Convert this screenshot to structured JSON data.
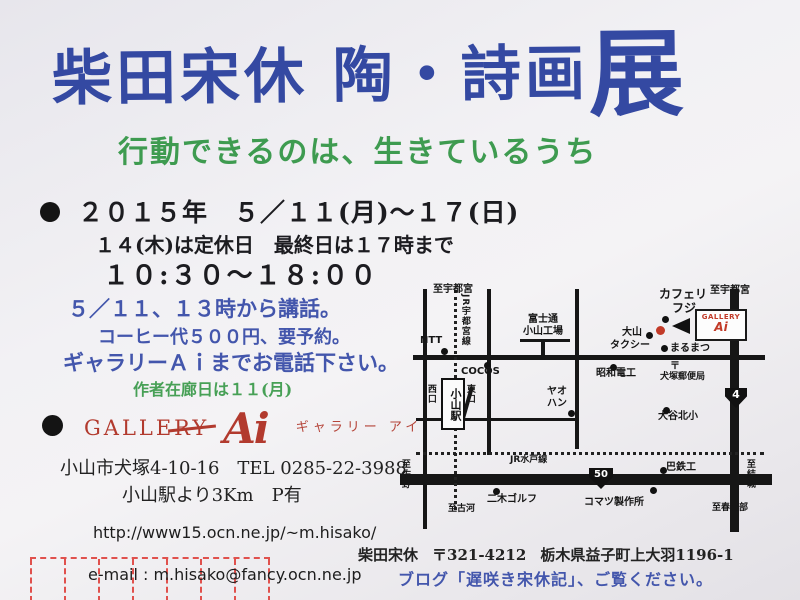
{
  "title": {
    "calligraphy_main": "柴田宋休 陶・詩画",
    "calligraphy_last": "展",
    "subtitle": "行動できるのは、生きているうち"
  },
  "schedule": {
    "bullet": "●",
    "dates": "２０１５年　５／１１(月)～１７(日)",
    "closed": "１４(木)は定休日　最終日は１７時まで",
    "hours": "１０:３０～１８:００"
  },
  "event_notes": {
    "talk": "５／１１、１３時から講話。",
    "coffee": "コーヒー代５００円、要予約。",
    "phone": "ギャラリーＡｉまでお電話下さい。",
    "presence": "作者在廊日は１１(月)"
  },
  "gallery": {
    "bullet": "●",
    "name_en": "GALLERY",
    "logo_script": "Ai",
    "name_kana": "ギャラリー アイ",
    "address": "小山市犬塚4-10-16　TEL 0285-22-3988",
    "access": "小山駅より3Km　P有"
  },
  "contact": {
    "url": "http://www15.ocn.ne.jp/~m.hisako/",
    "email": "e-mail : m.hisako@fancy.ocn.ne.jp"
  },
  "artist": {
    "name": "柴田宋休",
    "postal": "〒321-4212",
    "address": "栃木県益子町上大羽1196-1",
    "blog": "ブログ「遅咲き宋休記」、ご覧ください。"
  },
  "map": {
    "station_label": "小山駅",
    "gallery_box": {
      "line1": "GALLERY",
      "line2": "Ai"
    },
    "route_shields": [
      {
        "number": "4"
      },
      {
        "number": "50"
      }
    ],
    "labels": [
      "至宇都宮",
      "JR宇都宮線",
      "NTT",
      "富士通",
      "小山工場",
      "カフェリ",
      "フジ",
      "至宇都宮",
      "大山",
      "タクシー",
      "まるまつ",
      "昭和電工",
      "〒",
      "犬塚郵便局",
      "COCOS",
      "西口",
      "東口",
      "ヤオ",
      "ハン",
      "大谷北小",
      "JR水戸線",
      "巴鉄工",
      "二木ゴルフ",
      "コマツ製作所",
      "至佐野",
      "至古河",
      "至結城",
      "至春日部"
    ]
  },
  "colors": {
    "title_blue": "#3449a2",
    "subtitle_green": "#3e9b50",
    "note_blue": "#4356ac",
    "logo_red": "#b23a2e",
    "map_marker_red": "#c23a28",
    "postal_frame_red": "#e0514d",
    "ink_black": "#1c1c20",
    "paper": "#f2f1f4"
  }
}
